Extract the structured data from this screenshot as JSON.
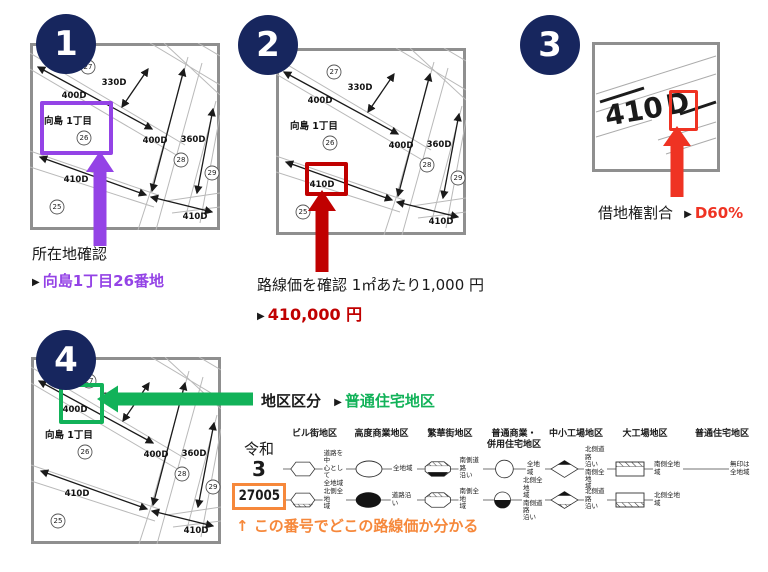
{
  "colors": {
    "navy": "#17265E",
    "purple": "#9443E6",
    "dark_red": "#C00000",
    "bright_red": "#EF3323",
    "green": "#12B259",
    "orange": "#F6883B",
    "map_border": "#8F8F8F"
  },
  "steps": {
    "s1": {
      "number": "1",
      "title": "所在地確認",
      "marker": "▶",
      "value": "向島1丁目26番地"
    },
    "s2": {
      "number": "2",
      "title": "路線価を確認 1㎡あたり1,000 円",
      "marker": "▶",
      "value": "410,000 円"
    },
    "s3": {
      "number": "3",
      "title": "借地権割合",
      "marker": "▶",
      "value": "D60%"
    },
    "s4": {
      "number": "4",
      "title": "地区区分",
      "marker": "▶",
      "value": "普通住宅地区"
    }
  },
  "map": {
    "district_label": "向島 1丁目",
    "roads": {
      "top": "400D",
      "upper": "330D",
      "mid": "400D",
      "right": "360D",
      "left": "410D",
      "bottom": "410D"
    },
    "blocks": {
      "b27": "27",
      "b26": "26",
      "b28": "28",
      "b29": "29",
      "b25": "25"
    }
  },
  "zoom_map": {
    "number": "410",
    "letter": "D"
  },
  "legend": {
    "era": "令和",
    "year": "3",
    "page_number": "27005",
    "note": "↑ この番号でどこの路線価か分かる",
    "columns": [
      {
        "header": "ビル街地区",
        "rows": [
          {
            "label": "道路を中\n心として\n全地域"
          },
          {
            "label": "北側全地\n域"
          }
        ]
      },
      {
        "header": "高度商業地区",
        "rows": [
          {
            "label": "全地域"
          },
          {
            "label": "道路沿い"
          }
        ]
      },
      {
        "header": "繁華街地区",
        "rows": [
          {
            "label": "南側道路\n沿い"
          },
          {
            "label": "南側全地\n域"
          }
        ]
      },
      {
        "header": "普通商業・\n併用住宅地区",
        "rows": [
          {
            "label": "全地域"
          },
          {
            "label": "北側全地\n域\n南側道路\n沿い"
          }
        ]
      },
      {
        "header": "中小工場地区",
        "rows": [
          {
            "label": "北側道路\n沿い\n南側全地\n域"
          },
          {
            "label": "北側道路\n沿い"
          }
        ]
      },
      {
        "header": "大工場地区",
        "rows": [
          {
            "label": "南側全地\n域"
          },
          {
            "label": "北側全地\n域"
          }
        ]
      },
      {
        "header": "普通住宅地区",
        "rows": [
          {
            "label": "無印は\n全地域"
          },
          {
            "label": ""
          }
        ]
      }
    ]
  }
}
